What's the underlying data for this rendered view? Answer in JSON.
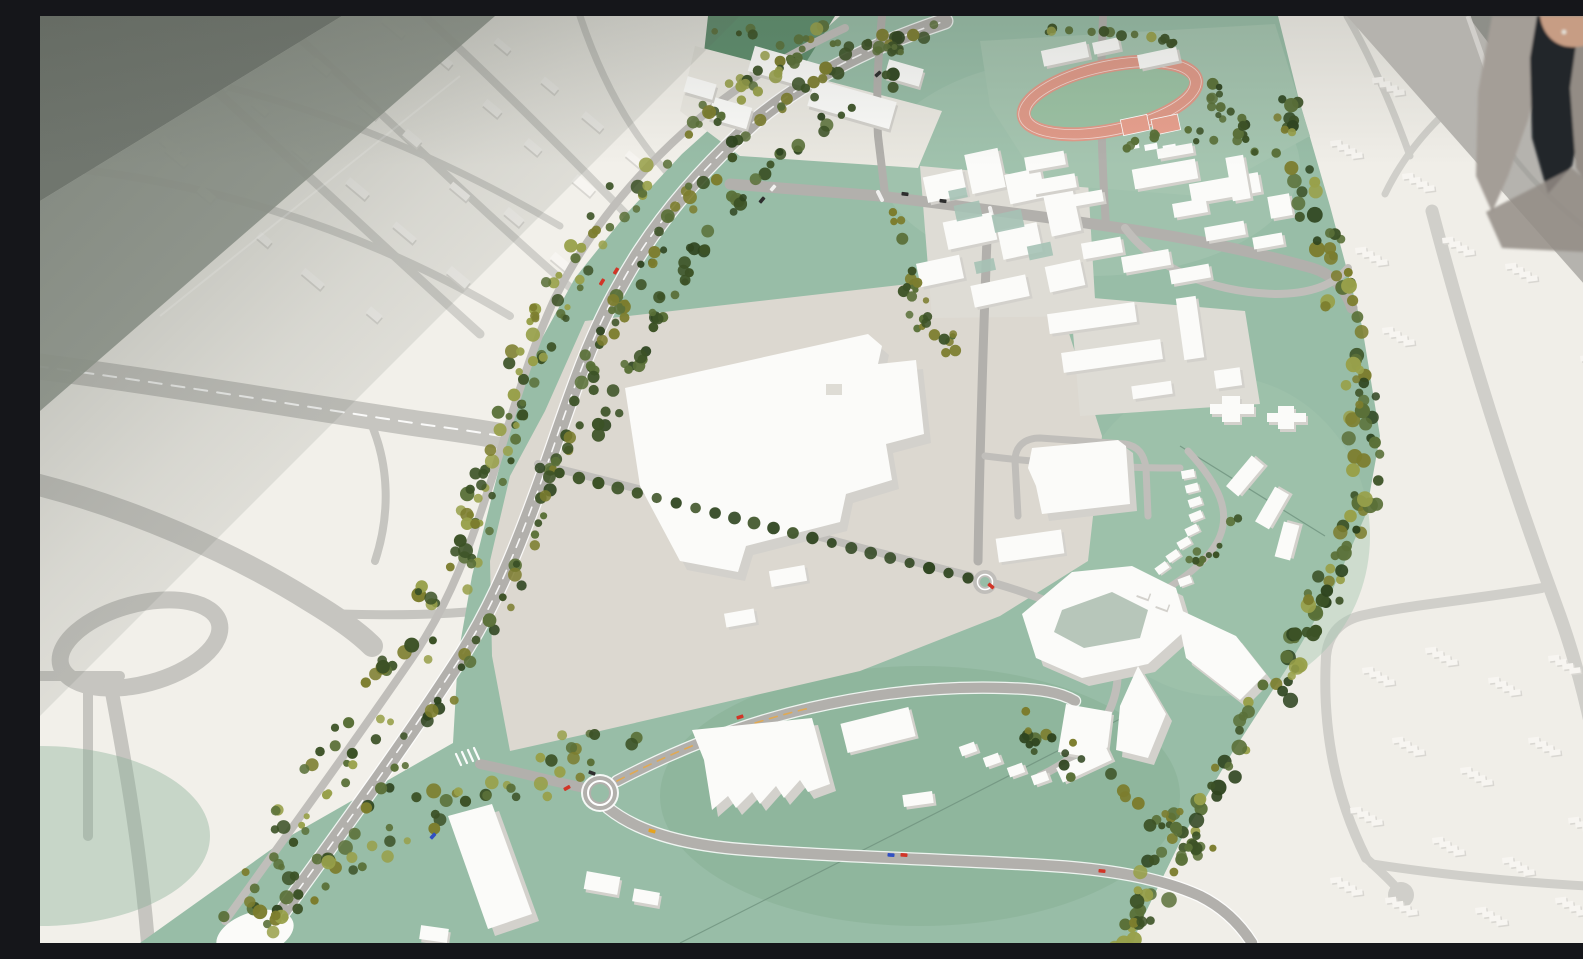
{
  "meta": {
    "description": "Photograph of a physical architectural scale model of an urban development area, seen from above at an oblique angle. A green landscaped corridor with model trees, white volumetric buildings, grey roads, roundabouts and tiny coloured cars runs diagonally across a flat white context model printed with grey roads and low-relief building footprints. A running track with salmon-coloured lanes sits at the top, and a person stands partially visible at the top right corner.",
    "caption": "Urban planning scale model with white buildings, sage-green landscaping, model trees, roundabouts and miniature cars; a visitor stands at the top-right edge."
  },
  "palette": {
    "base": "#edebe6",
    "terrain_left": "#f2f0ea",
    "terrain_right": "#f0eee8",
    "flat_road": "#c6c5c0",
    "flat_road_light": "#d0cfca",
    "shadow_dark": "#7b817a",
    "shadow_mid": "#99a096",
    "wedge_mid": "#b5b3ae",
    "wedge_dark": "#8e8f89",
    "wedge_road": "#a6a5a0",
    "grass": "#98bda7",
    "grass_dark": "#88b096",
    "grass_light": "#a5c5b0",
    "grass_wedge": "#5f8e6e",
    "field_line": "#6f927e",
    "lot": "#dcd8d0",
    "pavement": "#dedcd5",
    "pavement_light": "#eae8e1",
    "road": "#b2b0ac",
    "road_light": "#c0beba",
    "lane_yellow": "#e3a94f",
    "track": "#e09a89",
    "court": "#e8a08e",
    "infield": "#9cc2a4",
    "bldg": "#fbfbf9",
    "bldg_shade": "#d3d1cc",
    "bldg_dark": "#c3c1bc",
    "teal_roof": "#a5c2b5",
    "courtyard": "#b7c6ba",
    "relief_face": "#f7f5f1",
    "relief_shadow": "#d9d7d2",
    "tree_deep": "#2f4520",
    "tree_dark": "#3c5226",
    "tree_mid": "#5a7038",
    "tree_olive": "#7c7d2e",
    "tree_light": "#98a04a",
    "car_red": "#d13527",
    "car_blue": "#2f4fc2",
    "car_yellow": "#e6a31e",
    "car_black": "#2e2e2e",
    "car_white": "#f2f2f0",
    "person_knit": "#a49e97",
    "person_knit2": "#938c85",
    "person_dark": "#24252c",
    "person_skin": "#c79d84",
    "person_ring": "#e4e1d8",
    "white": "#ffffff"
  },
  "scene": {
    "regions": [
      "context-model-west-with-printed-motorway-interchange",
      "context-model-east-with-relief-housing",
      "central-development-corridor-green",
      "tree-lined-main-road",
      "industrial-lot-with-large-warehouse",
      "campus-cluster-with-green-roofs",
      "sports-grounds-with-running-track",
      "hospital-campus",
      "residential-ring-complex",
      "shadowed-model-edge-top-left",
      "shadowed-model-edge-top-right"
    ],
    "landmarks": [
      "running-track",
      "tennis-courts",
      "large-warehouse",
      "big-roundabout-with-white-ring",
      "small-roundabout",
      "oval-roundabout-printed",
      "motorway-with-dashed-line",
      "zebra-crossing",
      "cul-de-sac",
      "tree-belt",
      "observer-person"
    ],
    "vehicles": {
      "count": 15,
      "colors": [
        "red",
        "blue",
        "yellow",
        "black",
        "white"
      ]
    },
    "person": {
      "position": "top-right",
      "details": "partially visible, grey knit cardigan over dark clothing, hand with ring"
    }
  }
}
